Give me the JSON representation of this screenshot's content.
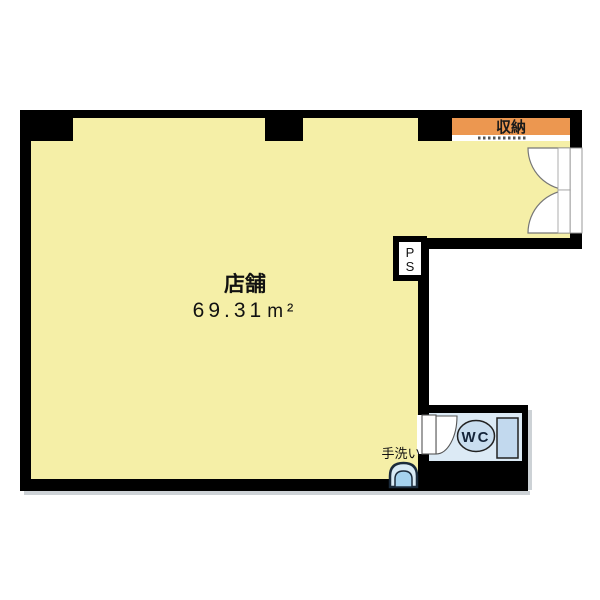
{
  "plan": {
    "type": "floor-plan",
    "rooms": {
      "shop": {
        "label": "店舗",
        "area_value": "69.31",
        "area_unit": "m²"
      },
      "storage": {
        "label": "収納"
      },
      "wc": {
        "label": "WC"
      },
      "pipe_space": {
        "line1": "P",
        "line2": "S"
      },
      "hand_wash": {
        "label": "手洗い"
      }
    }
  },
  "colors": {
    "background": "#FFFFFF",
    "wall": "#000000",
    "floor": "#F5EFA7",
    "storage_band": "#EC9750",
    "wc_floor": "#DCEAF5",
    "toilet_fill": "#C9DEF0",
    "tank_fill": "#C2D9EE",
    "sink_outer": "#D8EAF5",
    "sink_inner": "#A5D2EE",
    "door_arc": "#777777",
    "shadow": "#CDD2D6"
  }
}
